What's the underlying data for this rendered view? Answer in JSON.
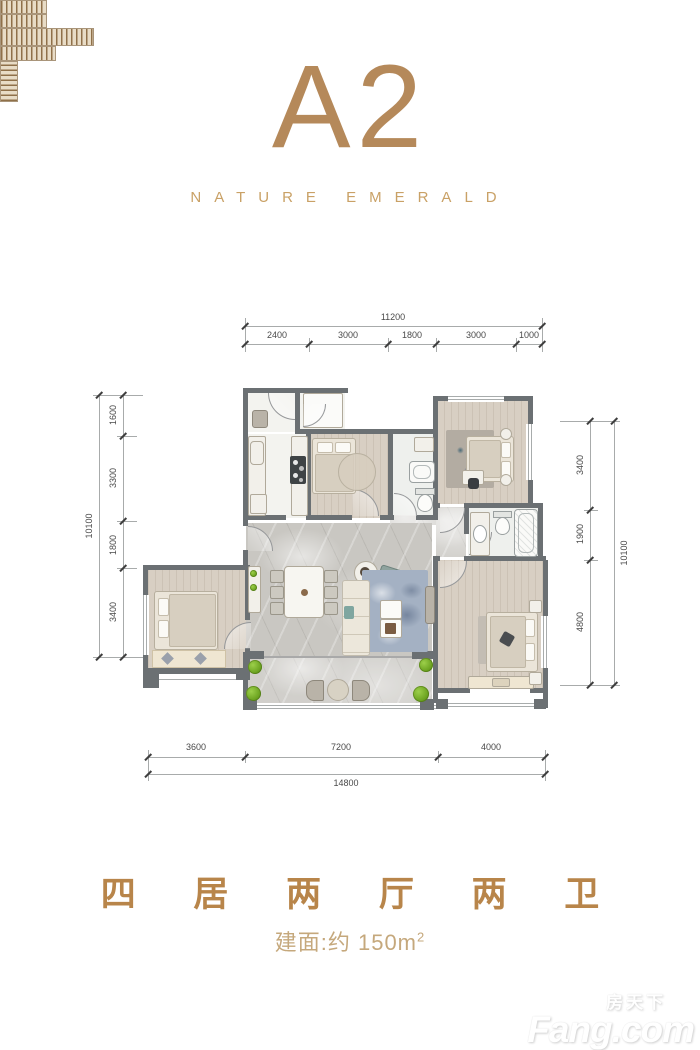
{
  "header": {
    "title": "A2",
    "subtitle": "NATURE EMERALD"
  },
  "dims": {
    "top": {
      "total": "11200",
      "segments": [
        "2400",
        "3000",
        "1800",
        "3000",
        "1000"
      ]
    },
    "left": {
      "total": "10100",
      "segments": [
        "1600",
        "3300",
        "1800",
        "3400"
      ]
    },
    "right": {
      "total": "10100",
      "segments": [
        "3400",
        "1900",
        "4800"
      ]
    },
    "bottom": {
      "total": "14800",
      "segments": [
        "3600",
        "7200",
        "4000"
      ]
    }
  },
  "footer": {
    "layout_title": "四 居 两 厅 两 卫",
    "area_label": "建面:约 150m",
    "area_sup": "2"
  },
  "watermark": {
    "cn": "房天下",
    "en": "Fang.com"
  },
  "colors": {
    "accent": "#b5895a",
    "accent_light": "#c9a166",
    "footer_gold": "#b8854a",
    "wall": "#6b7073"
  }
}
